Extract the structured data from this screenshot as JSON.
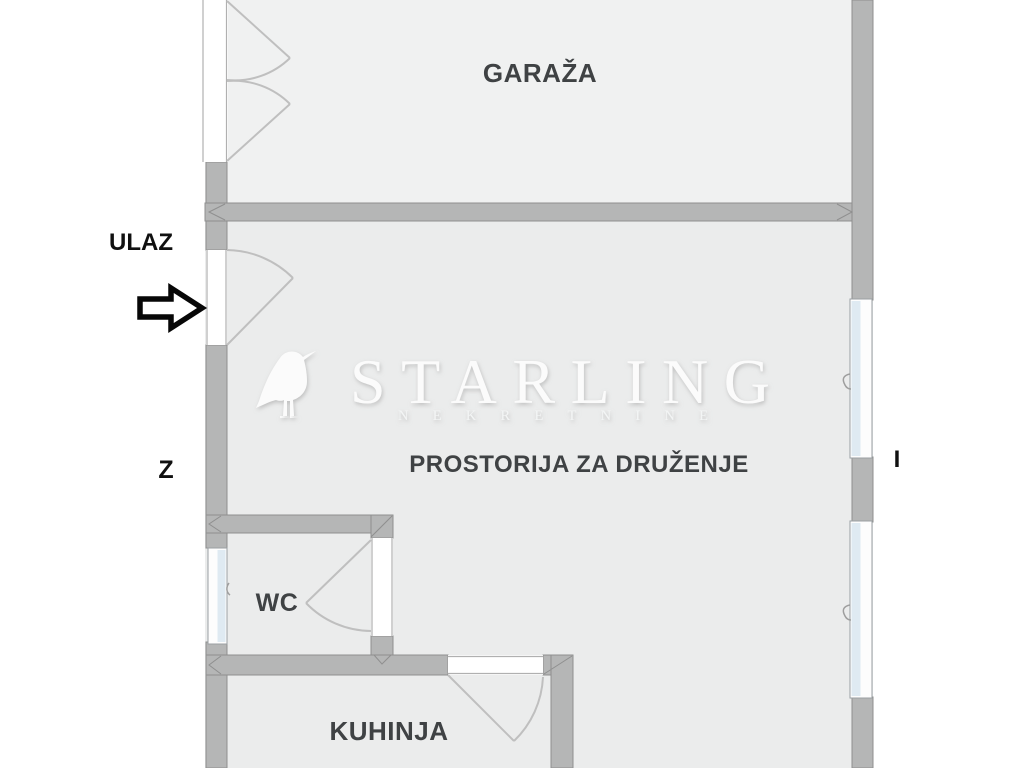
{
  "colors": {
    "outside": "#ffffff",
    "floor": "#ebecec",
    "garage_floor": "#f0f1f1",
    "wall": "#b5b6b6",
    "wall_outline": "#8f8f8f",
    "opening": "#ffffff",
    "jamb": "#b0b0b0",
    "window_frame": "#9aa0a3",
    "window_glass": "#dfeaf2",
    "door_arc": "#bfbfbf",
    "label": "#3f4244",
    "annotation": "#101010",
    "watermark": "#fbfbfb",
    "watermark_sub": "#f3f5f5"
  },
  "rooms": [
    {
      "id": "garage",
      "label": "GARAŽA"
    },
    {
      "id": "living",
      "label": "PROSTORIJA ZA DRUŽENJE"
    },
    {
      "id": "wc",
      "label": "WC"
    },
    {
      "id": "kitchen",
      "label": "KUHINJA"
    }
  ],
  "annotations": {
    "entrance_label": "ULAZ",
    "compass_west": "Z",
    "compass_east": "I"
  },
  "watermark": {
    "brand": "STARLING",
    "subtitle": "NEKRETNINE",
    "logo": "starling-bird"
  }
}
